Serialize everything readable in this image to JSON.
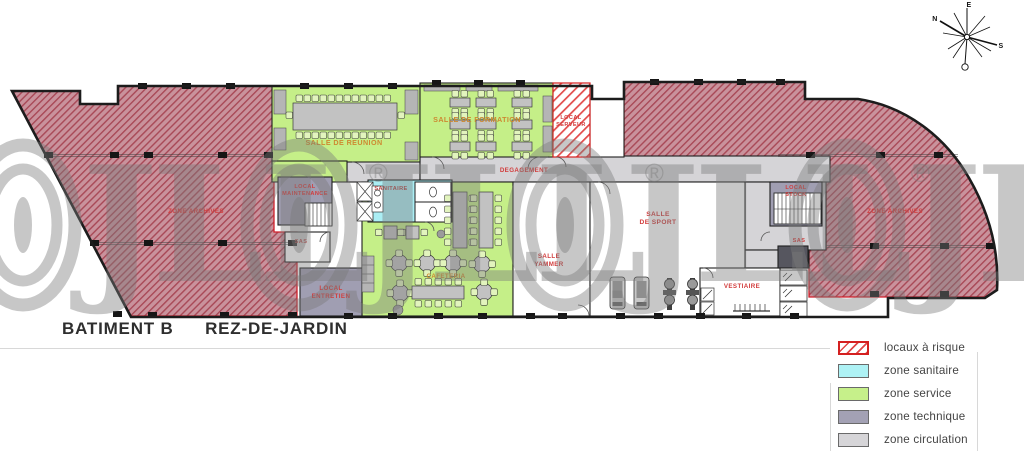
{
  "title": {
    "building": "BATIMENT B",
    "level": "REZ-DE-JARDIN"
  },
  "compass": {
    "n": "N",
    "e": "E",
    "s": "S",
    "o": "O"
  },
  "watermark": {
    "letters": "JLL",
    "registered": "®"
  },
  "rooms": {
    "archives_left": "ZONE ARCHIVES",
    "archives_right": "ZONE ARCHIVES",
    "reunion": "SALLE DE REUNION",
    "formation": "SALLE DE FORMATION",
    "serveur_l1": "LOCAL",
    "serveur_l2": "SERVEUR",
    "degagement": "DEGAGEMENT",
    "maintenance_l1": "LOCAL",
    "maintenance_l2": "MAINTENANCE",
    "sas_left": "SAS",
    "entretien_l1": "LOCAL",
    "entretien_l2": "ENTRETIEN",
    "sanitaire": "SANITAIRE",
    "cafeteria": "CAFETERIA",
    "yammer_l1": "SALLE",
    "yammer_l2": "YAMMER",
    "sport_l1": "SALLE",
    "sport_l2": "DE SPORT",
    "vestiaire": "VESTIAIRE",
    "stock_l1": "LOCAL",
    "stock_l2": "STOCK",
    "sas_right": "SAS"
  },
  "legend": {
    "items": [
      {
        "id": "locaux-a-risque",
        "label": "locaux à risque",
        "swatch": "hatch",
        "color": "#d42020"
      },
      {
        "id": "zone-sanitaire",
        "label": "zone sanitaire",
        "swatch": "fill",
        "color": "#aef2f5"
      },
      {
        "id": "zone-service",
        "label": "zone service",
        "swatch": "fill",
        "color": "#c6f08a"
      },
      {
        "id": "zone-technique",
        "label": "zone technique",
        "swatch": "fill",
        "color": "#a3a1b4"
      },
      {
        "id": "zone-circulation",
        "label": "zone circulation",
        "swatch": "fill",
        "color": "#d6d5d8"
      }
    ]
  },
  "colors": {
    "risk_border": "#d42020",
    "risk_zone_fill": "#c9929c",
    "service_green": "#c5ef88",
    "sanitary_cyan": "#abeef4",
    "technique_purple": "#a09eb2",
    "circulation_gray": "#d5d4d7",
    "label_red": "#d23c3c",
    "label_orange": "#cd8931",
    "wall": "#1c1c1c"
  }
}
